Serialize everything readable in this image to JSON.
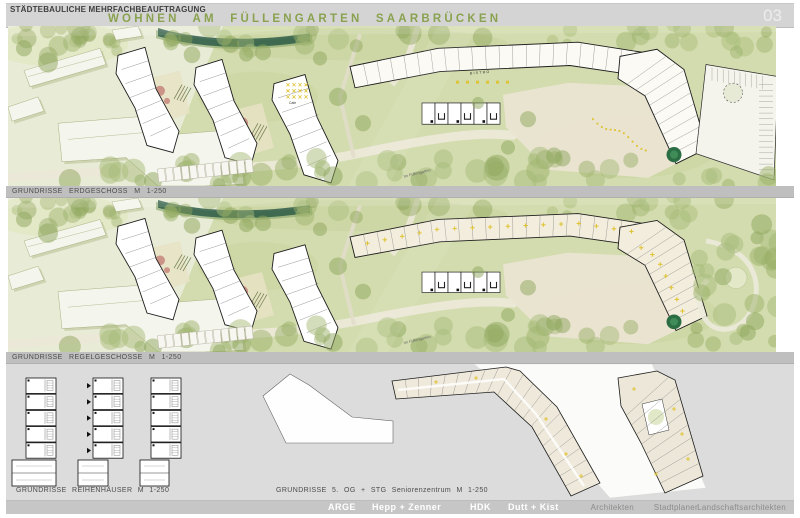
{
  "header": {
    "kicker": "STÄDTEBAULICHE MEHRFACHBEAUFTRAGUNG",
    "title": "WOHNEN AM FÜLLENGARTEN SAARBRÜCKEN",
    "page_number": "03"
  },
  "sections": {
    "plan1_label": "GRUNDRISSE  ERDGESCHOSS  M 1-250",
    "plan2_label": "GRUNDRISSE  REGELGESCHOSSE   M 1-250",
    "rowhouses_label": "GRUNDRISSE REIHENHÄUSER   M 1-250",
    "seniorcenter_label": "GRUNDRISSE 5. OG + STG Seniorenzentrum   M 1-250"
  },
  "plan_annotations": {
    "bistro": "BISTRO",
    "cafe": "Cafe",
    "street": "Im Füllengarten"
  },
  "footer": {
    "arge": "ARGE",
    "firm1": "Hepp + Zenner",
    "firm2": "HDK",
    "firm3": "Dutt + Kist",
    "role1": "Architekten",
    "role2": "Stadtplaner",
    "role3": "Landschaftsarchitekten"
  },
  "palette": {
    "header_gray": "#d4d4d4",
    "band_gray": "#bfbfbf",
    "section_gray": "#dcdcdc",
    "footer_gray": "#c6c6c6",
    "title_green": "#8aa24f",
    "text_dark": "#3f3f3f",
    "plan_base": "#d3dcae",
    "plan_pale": "#e9ecd8",
    "lawn": "#c9d49e",
    "tree_green": "#9cb26a",
    "tree_green2": "#a8bc79",
    "tree_dark": "#8ea55c",
    "road": "#ece8d8",
    "plaza": "#eae4d2",
    "stream": "#2e5c48",
    "stream_fringe": "#86a468",
    "building_white": "#ffffff",
    "building_outline": "#1d1d1d",
    "existing_fill": "#f4f5ec",
    "existing_edge": "#a9b07f",
    "existing_shadow": "#a7b07e",
    "room_beige": "#f2eddd",
    "garden_beige": "#e6e3c4",
    "playground_pink": "#c9897f",
    "accent_gold": "#dfc22e",
    "accent_dark_green": "#2c6e44",
    "page_number_light": "#ededed"
  }
}
